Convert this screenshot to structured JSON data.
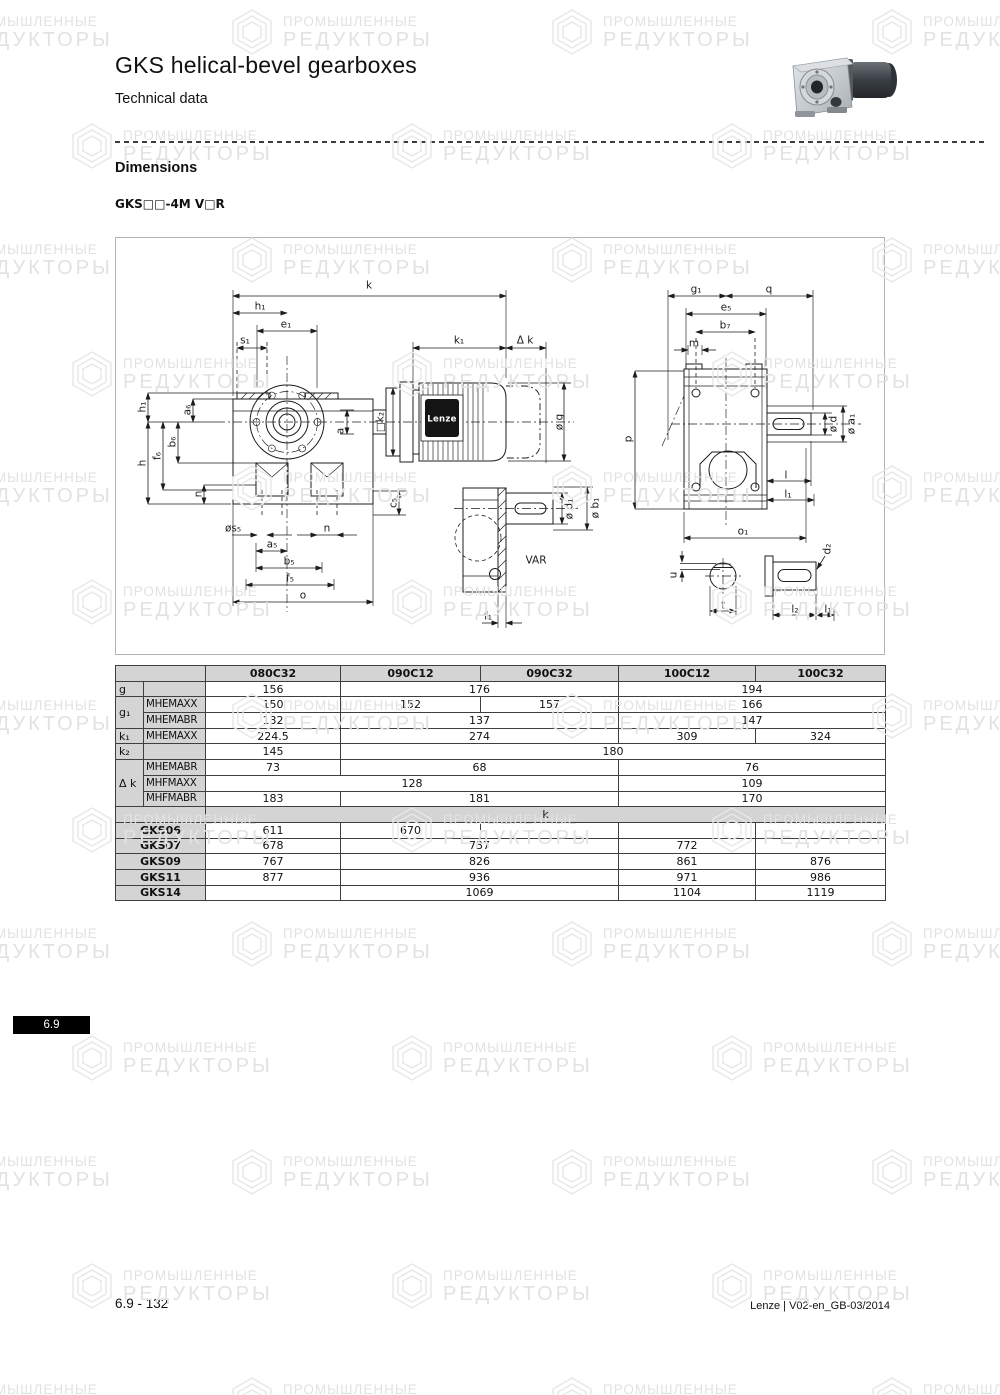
{
  "page": {
    "title": "GKS helical-bevel gearboxes",
    "subtitle": "Technical data",
    "section_heading": "Dimensions",
    "model_code": "GKS□□-4M V□R",
    "side_tab": "6.9",
    "footer_left": "6.9 - 132",
    "footer_right": "Lenze | V02-en_GB-03/2014"
  },
  "watermark": {
    "line1": "ПРОМЫШЛЕННЫЕ",
    "line2": "РЕДУКТОРЫ"
  },
  "diagram": {
    "brand_label": "Lenze",
    "labels": [
      {
        "t": "k",
        "x": 253,
        "y": 47
      },
      {
        "t": "h₁",
        "x": 144,
        "y": 68
      },
      {
        "t": "e₁",
        "x": 170,
        "y": 86
      },
      {
        "t": "s₁",
        "x": 129,
        "y": 102
      },
      {
        "t": "k₁",
        "x": 343,
        "y": 102
      },
      {
        "t": "Δ k",
        "x": 409,
        "y": 102
      },
      {
        "t": "ø g",
        "x": 443,
        "y": 184,
        "r": 1
      },
      {
        "t": "h₁",
        "x": 26,
        "y": 169,
        "r": 1
      },
      {
        "t": "a₆",
        "x": 71,
        "y": 172,
        "r": 1
      },
      {
        "t": "b₆",
        "x": 56,
        "y": 204,
        "r": 1
      },
      {
        "t": "f₆",
        "x": 41,
        "y": 218,
        "r": 1
      },
      {
        "t": "h",
        "x": 26,
        "y": 225,
        "r": 1
      },
      {
        "t": "n",
        "x": 82,
        "y": 256,
        "r": 1
      },
      {
        "t": "□k₂",
        "x": 264,
        "y": 184,
        "r": 1
      },
      {
        "t": "a",
        "x": 224,
        "y": 193,
        "r": 1
      },
      {
        "t": "c₅",
        "x": 277,
        "y": 265,
        "r": 1
      },
      {
        "t": "øs₅",
        "x": 117,
        "y": 290
      },
      {
        "t": "n",
        "x": 211,
        "y": 290
      },
      {
        "t": "a₅",
        "x": 156,
        "y": 306
      },
      {
        "t": "b₅",
        "x": 173,
        "y": 323
      },
      {
        "t": "f₅",
        "x": 174,
        "y": 340
      },
      {
        "t": "o",
        "x": 187,
        "y": 357
      },
      {
        "t": "ø d₁",
        "x": 453,
        "y": 271,
        "r": 1
      },
      {
        "t": "ø b₁",
        "x": 479,
        "y": 270,
        "r": 1
      },
      {
        "t": "VAR",
        "x": 420,
        "y": 322
      },
      {
        "t": "f₁",
        "x": 372,
        "y": 378
      },
      {
        "t": "g₁",
        "x": 580,
        "y": 51
      },
      {
        "t": "q",
        "x": 653,
        "y": 51
      },
      {
        "t": "e₅",
        "x": 610,
        "y": 69
      },
      {
        "t": "b₇",
        "x": 609,
        "y": 87
      },
      {
        "t": "m",
        "x": 578,
        "y": 105
      },
      {
        "t": "p",
        "x": 512,
        "y": 201,
        "r": 1
      },
      {
        "t": "ø d",
        "x": 717,
        "y": 186,
        "r": 1
      },
      {
        "t": "ø a₁",
        "x": 735,
        "y": 186,
        "r": 1
      },
      {
        "t": "l",
        "x": 670,
        "y": 237
      },
      {
        "t": "l₁",
        "x": 672,
        "y": 256
      },
      {
        "t": "o₁",
        "x": 627,
        "y": 293
      },
      {
        "t": "u",
        "x": 557,
        "y": 337,
        "r": 1
      },
      {
        "t": "t",
        "x": 607,
        "y": 367
      },
      {
        "t": "d₂",
        "x": 711,
        "y": 311,
        "r": 1
      },
      {
        "t": "l₂",
        "x": 679,
        "y": 371
      },
      {
        "t": "l₁",
        "x": 712,
        "y": 371
      }
    ]
  },
  "table": {
    "columns": [
      "080C32",
      "090C12",
      "090C32",
      "100C12",
      "100C32"
    ],
    "rows": [
      {
        "cells": [
          {
            "t": "",
            "type": "label",
            "cs": 2
          },
          {
            "t": "080C32",
            "type": "header"
          },
          {
            "t": "090C12",
            "type": "header"
          },
          {
            "t": "090C32",
            "type": "header"
          },
          {
            "t": "100C12",
            "type": "header"
          },
          {
            "t": "100C32",
            "type": "header"
          }
        ]
      },
      {
        "cells": [
          {
            "t": "g",
            "type": "label"
          },
          {
            "t": "",
            "type": "label"
          },
          {
            "t": "156",
            "type": "value"
          },
          {
            "t": "176",
            "type": "value",
            "cs": 2
          },
          {
            "t": "194",
            "type": "value",
            "cs": 2
          }
        ]
      },
      {
        "cells": [
          {
            "t": "g₁",
            "type": "label",
            "rs": 2
          },
          {
            "t": "MHEMAXX",
            "type": "sublabel"
          },
          {
            "t": "150",
            "type": "value"
          },
          {
            "t": "152",
            "type": "value"
          },
          {
            "t": "157",
            "type": "value"
          },
          {
            "t": "166",
            "type": "value",
            "cs": 2
          }
        ]
      },
      {
        "cells": [
          {
            "t": "MHEMABR",
            "type": "sublabel"
          },
          {
            "t": "132",
            "type": "value"
          },
          {
            "t": "137",
            "type": "value",
            "cs": 2
          },
          {
            "t": "147",
            "type": "value",
            "cs": 2
          }
        ]
      },
      {
        "cells": [
          {
            "t": "k₁",
            "type": "label"
          },
          {
            "t": "MHEMAXX",
            "type": "sublabel"
          },
          {
            "t": "224.5",
            "type": "value"
          },
          {
            "t": "274",
            "type": "value",
            "cs": 2
          },
          {
            "t": "309",
            "type": "value"
          },
          {
            "t": "324",
            "type": "value"
          }
        ]
      },
      {
        "cells": [
          {
            "t": "k₂",
            "type": "label"
          },
          {
            "t": "",
            "type": "label"
          },
          {
            "t": "145",
            "type": "value"
          },
          {
            "t": "180",
            "type": "value",
            "cs": 4
          }
        ]
      },
      {
        "cells": [
          {
            "t": "Δ k",
            "type": "label",
            "rs": 3
          },
          {
            "t": "MHEMABR",
            "type": "sublabel"
          },
          {
            "t": "73",
            "type": "value"
          },
          {
            "t": "68",
            "type": "value",
            "cs": 2
          },
          {
            "t": "76",
            "type": "value",
            "cs": 2
          }
        ]
      },
      {
        "cells": [
          {
            "t": "MHFMAXX",
            "type": "sublabel"
          },
          {
            "t": "128",
            "type": "value",
            "cs": 3
          },
          {
            "t": "109",
            "type": "value",
            "cs": 2
          }
        ]
      },
      {
        "cells": [
          {
            "t": "MHFMABR",
            "type": "sublabel"
          },
          {
            "t": "183",
            "type": "value"
          },
          {
            "t": "181",
            "type": "value",
            "cs": 2
          },
          {
            "t": "170",
            "type": "value",
            "cs": 2
          }
        ]
      },
      {
        "cells": [
          {
            "t": "",
            "type": "label",
            "cs": 2
          },
          {
            "t": "k",
            "type": "band",
            "cs": 5
          }
        ]
      },
      {
        "cells": [
          {
            "t": "GKS06",
            "type": "series",
            "cs": 2
          },
          {
            "t": "611",
            "type": "value"
          },
          {
            "t": "670",
            "type": "value"
          },
          {
            "t": "",
            "type": "value"
          },
          {
            "t": "",
            "type": "value"
          },
          {
            "t": "",
            "type": "value"
          }
        ]
      },
      {
        "cells": [
          {
            "t": "GKS07",
            "type": "series",
            "cs": 2
          },
          {
            "t": "678",
            "type": "value"
          },
          {
            "t": "737",
            "type": "value",
            "cs": 2
          },
          {
            "t": "772",
            "type": "value"
          },
          {
            "t": "",
            "type": "value"
          }
        ]
      },
      {
        "cells": [
          {
            "t": "GKS09",
            "type": "series",
            "cs": 2
          },
          {
            "t": "767",
            "type": "value"
          },
          {
            "t": "826",
            "type": "value",
            "cs": 2
          },
          {
            "t": "861",
            "type": "value"
          },
          {
            "t": "876",
            "type": "value"
          }
        ]
      },
      {
        "cells": [
          {
            "t": "GKS11",
            "type": "series",
            "cs": 2
          },
          {
            "t": "877",
            "type": "value"
          },
          {
            "t": "936",
            "type": "value",
            "cs": 2
          },
          {
            "t": "971",
            "type": "value"
          },
          {
            "t": "986",
            "type": "value"
          }
        ]
      },
      {
        "cells": [
          {
            "t": "GKS14",
            "type": "series",
            "cs": 2
          },
          {
            "t": "",
            "type": "value"
          },
          {
            "t": "1069",
            "type": "value",
            "cs": 2
          },
          {
            "t": "1104",
            "type": "value"
          },
          {
            "t": "1119",
            "type": "value"
          }
        ]
      }
    ]
  }
}
